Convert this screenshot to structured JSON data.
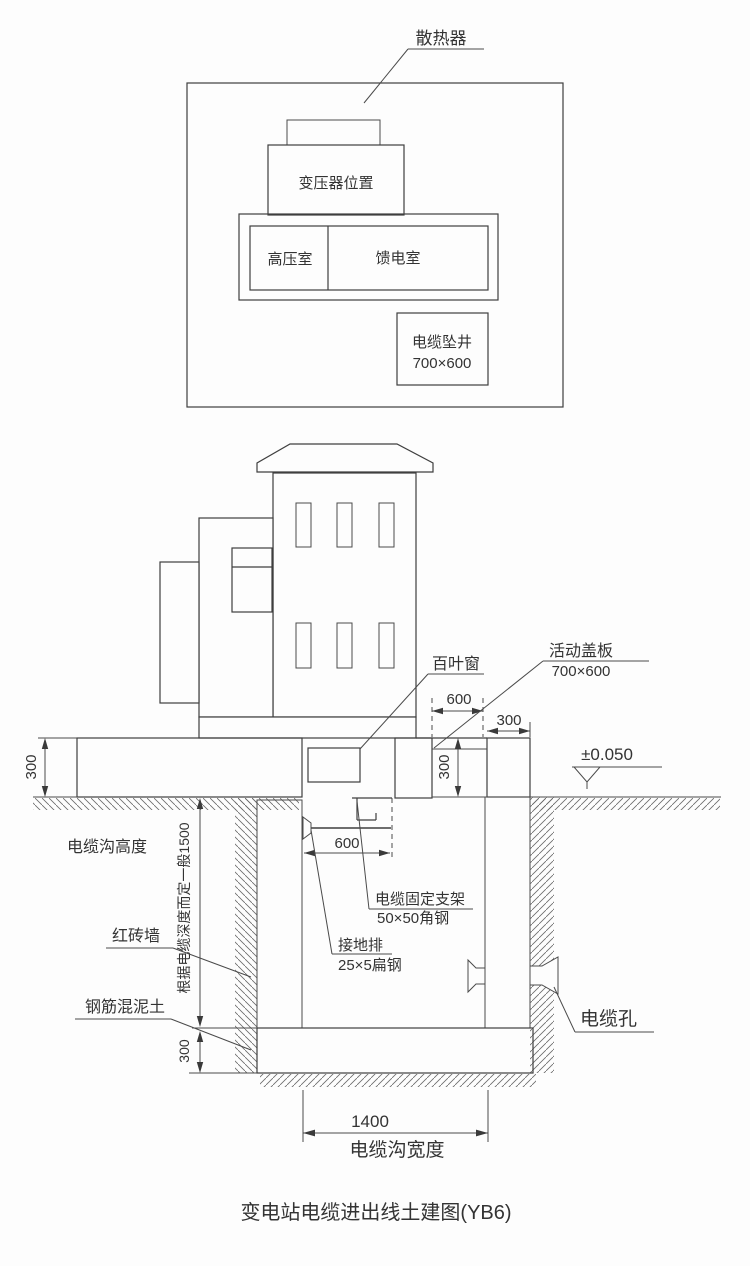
{
  "title": "变电站电缆进出线土建图(YB6)",
  "plan": {
    "radiator_label": "散热器",
    "transformer_label": "变压器位置",
    "hv_room_label": "高压室",
    "feeder_room_label": "馈电室",
    "shaft_label": "电缆坠井",
    "shaft_size": "700×600"
  },
  "section": {
    "louver_label": "百叶窗",
    "cover_label": "活动盖板",
    "cover_size": "700×600",
    "level_mark": "±0.050",
    "dim_cover_width": "600",
    "dim_wall_width": "300",
    "dim_cover_depth": "300",
    "dim_slab_thickness": "300",
    "trench_height_label": "电缆沟高度",
    "depth_note": "根据电缆深度而定一般1500",
    "brick_wall_label": "红砖墙",
    "concrete_label": "钢筋混泥土",
    "dim_floor_thickness": "300",
    "bracket_label_line1": "电缆固定支架",
    "bracket_label_line2": "50×50角钢",
    "ground_bar_label_line1": "接地排",
    "ground_bar_label_line2": "25×5扁钢",
    "dim_bracket_length": "600",
    "cable_hole_label": "电缆孔",
    "dim_trench_width": "1400",
    "trench_width_label": "电缆沟宽度"
  }
}
